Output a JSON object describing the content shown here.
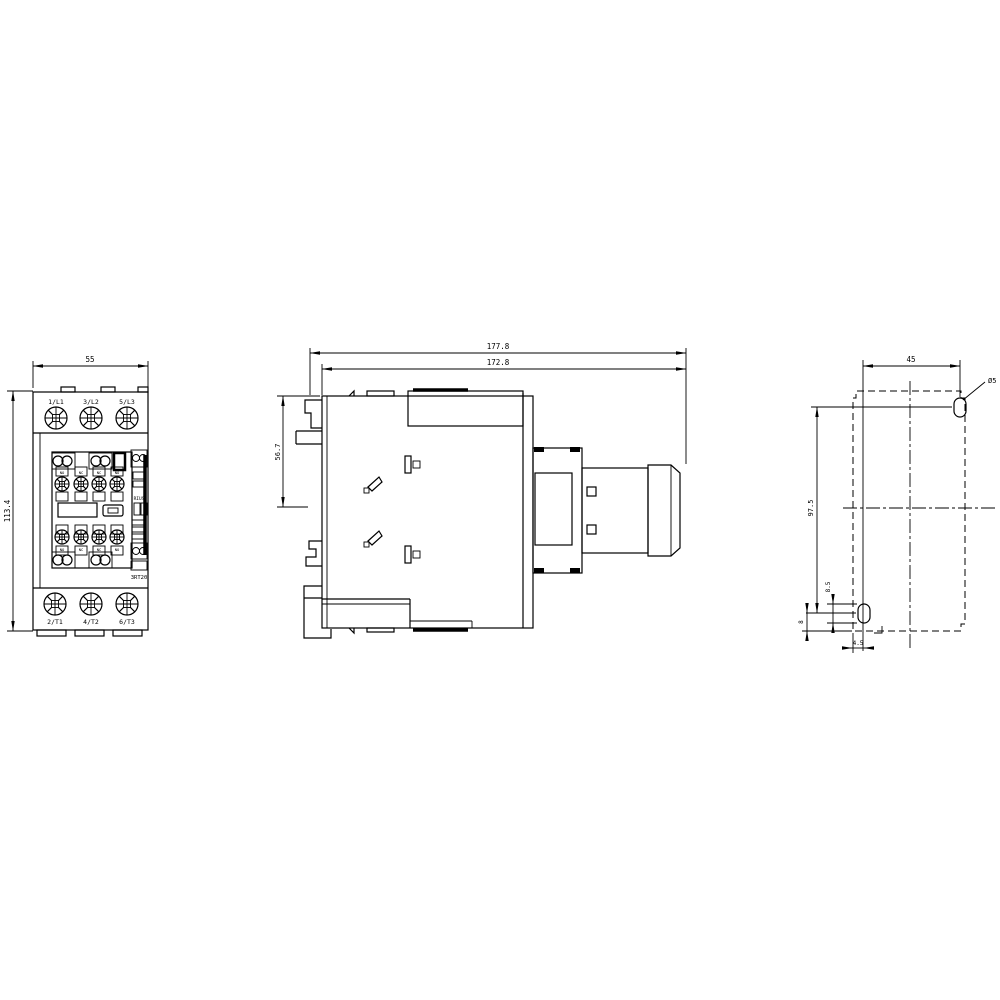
{
  "front_view": {
    "dim_width": "55",
    "dim_height": "113.4",
    "top_terminals": [
      "1/L1",
      "3/L2",
      "5/L3"
    ],
    "bottom_terminals": [
      "2/T1",
      "4/T2",
      "6/T3"
    ],
    "aux_top_labels": [
      "NO",
      "NC",
      "NC",
      "NO"
    ],
    "aux_bottom_labels": [
      "NO",
      "NC",
      "NC",
      "NO"
    ],
    "brand_text": "RIUS",
    "model_text": "3RT20"
  },
  "side_view": {
    "dim_depth_total": "177.8",
    "dim_depth_body": "172.8",
    "dim_height_front": "56.7"
  },
  "drill_plan": {
    "dim_horizontal_spacing": "45",
    "dim_vertical_spacing": "97.5",
    "hole_diameter": "Ø5",
    "dim_slot_length": "8.5",
    "dim_bottom_offset": "8",
    "dim_edge_offset": "4.5"
  },
  "colors": {
    "line": "#000000",
    "background": "#ffffff"
  }
}
